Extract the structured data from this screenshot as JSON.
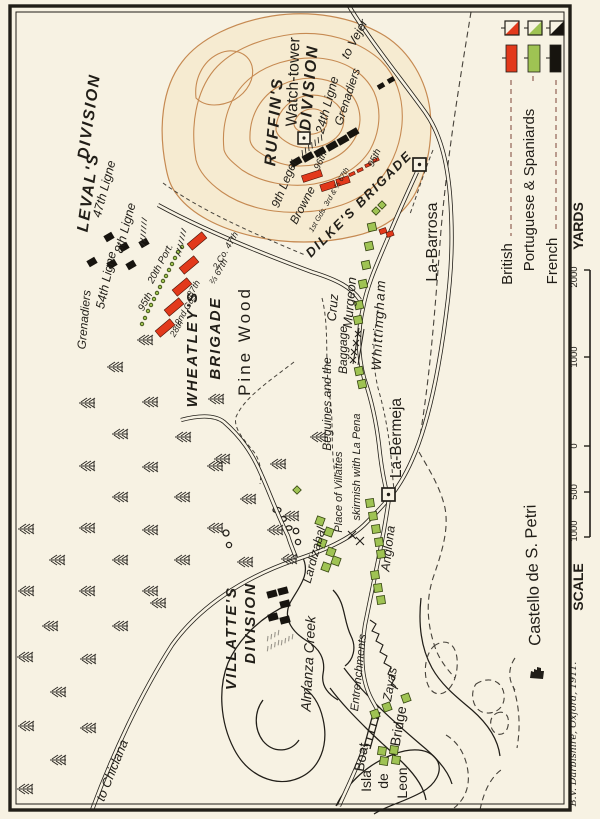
{
  "colors": {
    "paper": "#f7f2e3",
    "ink": "#211e18",
    "british_red": "#e2391b",
    "spanish_green": "#9fc353",
    "french_black": "#17140f",
    "contour": "#c68a52",
    "hill_fill": "#f6ebd1",
    "legend_dash": "#7c4437"
  },
  "legend": {
    "entries": [
      {
        "label": "British"
      },
      {
        "label": "Portuguese & Spaniards"
      },
      {
        "label": "French"
      }
    ]
  },
  "scale_bar": {
    "title": "SCALE",
    "unit": "YARDS",
    "ticks": [
      "2000",
      "1000",
      "0",
      "500",
      "1000"
    ]
  },
  "credit": "B.V. Darbishire, Oxford, 1911.",
  "labels": {
    "watch_tower": "Watch-tower",
    "ruffins": "RUFFIN'S",
    "ruffins_div": "DIVISION",
    "grenadiers_ruffin": "Grenadiers",
    "ligne_24": "24th Ligne",
    "inf_96": "96th",
    "leger_9": "9th Leger",
    "browne": "Browne",
    "gds_line": "1st Gds. 3rd & ⅔ 67th",
    "rifles_95_dilkes": "95th",
    "dilkes": "DILKE'S  BRIGADE",
    "to_vejer": "to Vejer",
    "la_barrosa": "La-Barrosa",
    "levals": "LEVAL'S",
    "levals_div": "DIVISION",
    "ligne_47": "47th Ligne",
    "ligne_8": "8th Ligne",
    "ligne_54": "54th Ligne",
    "grenadiers_leval": "Grenadiers",
    "port_20": "20th Port.",
    "rifles_95": "95th",
    "inf_28": "28th",
    "gds_2": "2nd Gds",
    "inf_87": "87th",
    "inf_67": "⅔ 67th",
    "co_47": "2 Co. 47th",
    "wheatleys": "WHEATLEY'S",
    "wheatleys_b": "BRIGADE",
    "pine_wood": "Pine Wood",
    "cruz": "Cruz",
    "murgeon": "Murgeon",
    "whittingham": "Whittingham",
    "beguines": "Beguines and the",
    "baggage": "Baggage",
    "la_bermeja": "La-Bermeja",
    "anglona": "Anglona",
    "lardizabal": "Lardizabal",
    "skirmish_1": "Place of Villattes",
    "skirmish_2": "skirmish with La Pena",
    "villattes": "VILLATTE'S",
    "villattes_div": "DIVISION",
    "almanza": "Almanza Creek",
    "entrenchments": "Entrenchments",
    "zayas": "Zayas",
    "boat": "Boat",
    "bridge": "Bridge",
    "isla": "Isla",
    "de": "de",
    "leon": "Leon",
    "castello": "Castello de S. Petri",
    "to_chiclana": "to Chiclana"
  }
}
